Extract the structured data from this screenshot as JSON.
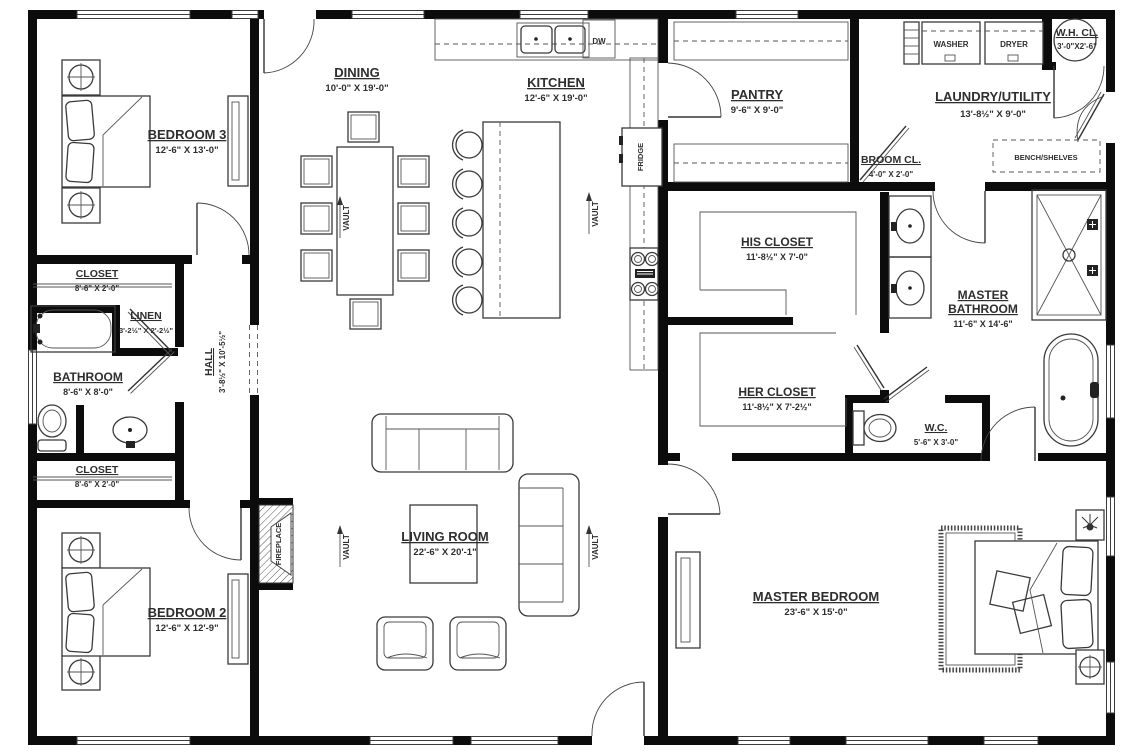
{
  "plan": {
    "rooms": {
      "bedroom3": {
        "name": "BEDROOM 3",
        "dims": "12'-6\" X 13'-0\""
      },
      "dining": {
        "name": "DINING",
        "dims": "10'-0\" X 19'-0\""
      },
      "kitchen": {
        "name": "KITCHEN",
        "dims": "12'-6\" X 19'-0\""
      },
      "pantry": {
        "name": "PANTRY",
        "dims": "9'-6\" X 9'-0\""
      },
      "laundry": {
        "name": "LAUNDRY/UTILITY",
        "dims": "13'-8½\" X 9'-0\""
      },
      "wh_closet": {
        "name": "W.H. CL.",
        "dims": "3'-0\"X2'-6\""
      },
      "broom_closet": {
        "name": "BROOM CL.",
        "dims": "4'-0\" X 2'-0\""
      },
      "closet_north": {
        "name": "CLOSET",
        "dims": "8'-6\" X 2'-0\""
      },
      "linen": {
        "name": "LINEN",
        "dims": "3'-2½\" X 2'-2½\""
      },
      "bathroom": {
        "name": "BATHROOM",
        "dims": "8'-6\" X 8'-0\""
      },
      "hall": {
        "name": "HALL",
        "dims": "3'-8½\" X 10'-5½\""
      },
      "closet_south": {
        "name": "CLOSET",
        "dims": "8'-6\" X 2'-0\""
      },
      "bedroom2": {
        "name": "BEDROOM 2",
        "dims": "12'-6\" X 12'-9\""
      },
      "living_room": {
        "name": "LIVING ROOM",
        "dims": "22'-6\" X 20'-1\""
      },
      "his_closet": {
        "name": "HIS CLOSET",
        "dims": "11'-8½\" X 7'-0\""
      },
      "her_closet": {
        "name": "HER CLOSET",
        "dims": "11'-8½\" X 7'-2½\""
      },
      "master_bathroom": {
        "name_line1": "MASTER",
        "name_line2": "BATHROOM",
        "dims": "11'-6\" X 14'-6\""
      },
      "wc": {
        "name": "W.C.",
        "dims": "5'-6\" X 3'-0\""
      },
      "master_bedroom": {
        "name": "MASTER BEDROOM",
        "dims": "23'-6\" X 15'-0\""
      }
    },
    "fixtures": {
      "washer": "WASHER",
      "dryer": "DRYER",
      "dishwasher": "DW",
      "fridge": "FRIDGE",
      "bench_shelves": "BENCH/SHELVES",
      "fireplace": "FIREPLACE",
      "vault": "VAULT"
    },
    "colors": {
      "wall": "#0c0c0c",
      "line": "#3a3a3a",
      "text": "#2e2e2e",
      "background": "#ffffff"
    }
  }
}
